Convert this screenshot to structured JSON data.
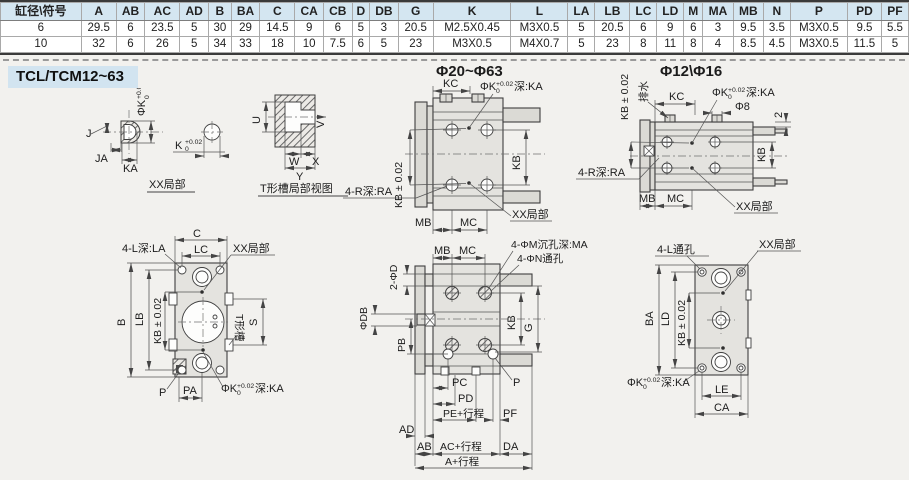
{
  "table": {
    "headers": [
      "缸径\\符号",
      "A",
      "AB",
      "AC",
      "AD",
      "B",
      "BA",
      "C",
      "CA",
      "CB",
      "D",
      "DB",
      "G",
      "K",
      "L",
      "LA",
      "LB",
      "LC",
      "LD",
      "M",
      "MA",
      "MB",
      "N",
      "P",
      "PD",
      "PF"
    ],
    "rows": [
      [
        "6",
        "29.5",
        "6",
        "23.5",
        "5",
        "30",
        "29",
        "14.5",
        "9",
        "6",
        "5",
        "3",
        "20.5",
        "M2.5X0.45",
        "M3X0.5",
        "5",
        "20.5",
        "6",
        "9",
        "6",
        "3",
        "9.5",
        "3.5",
        "M3X0.5",
        "9.5",
        "5.5"
      ],
      [
        "10",
        "32",
        "6",
        "26",
        "5",
        "34",
        "33",
        "18",
        "10",
        "7.5",
        "6",
        "5",
        "23",
        "M3X0.5",
        "M4X0.7",
        "5",
        "23",
        "8",
        "11",
        "8",
        "4",
        "8.5",
        "4.5",
        "M3X0.5",
        "11.5",
        "5"
      ]
    ]
  },
  "section_title": "TCL/TCM12~63",
  "tol": {
    "up": "+0.02",
    "dn": "0"
  },
  "colors": {
    "header_bg": "#d4e6f1",
    "section_bg": "#d2e4f0",
    "page_bg": "#f2f1ee",
    "line": "#3f3f3f",
    "body_fill": "#e4e3df"
  },
  "views": {
    "dome": {
      "caption": "XX局部",
      "j": "J",
      "ja": "JA",
      "ka": "KA",
      "phik": "ΦK",
      "k": "K"
    },
    "tslot": {
      "caption": "T形槽局部视图",
      "u": "U",
      "v": "V",
      "w": "W",
      "x": "X",
      "y": "Y"
    },
    "mid": {
      "title": "Φ20~Φ63",
      "kc": "KC",
      "phik": "ΦK",
      "depth_ka": "深:KA",
      "kb_tol": "KB ± 0.02",
      "kb": "KB",
      "r_depth": "4-R深:RA",
      "xx": "XX局部",
      "mb": "MB",
      "mc": "MC"
    },
    "right": {
      "title": "Φ12\\Φ16",
      "kb_tol": "KB ± 0.02",
      "drain": "排水",
      "kc": "KC",
      "phik": "ΦK",
      "depth_ka": "深:KA",
      "phi8": "Φ8",
      "two": "2",
      "kb": "KB",
      "r_depth": "4-R深:RA",
      "mb": "MB",
      "mc": "MC",
      "xx": "XX局部"
    },
    "front": {
      "l_depth": "4-L深:LA",
      "c": "C",
      "lc": "LC",
      "xx": "XX局部",
      "b": "B",
      "lb": "LB",
      "kb_tol": "KB ± 0.02",
      "s": "S",
      "tslot": "T形槽",
      "p": "P",
      "pa": "PA",
      "phik": "ΦK",
      "depth_ka": "深:KA"
    },
    "sec": {
      "mb": "MB",
      "mc": "MC",
      "m_holes": "4-ΦM沉孔深:MA",
      "n_holes": "4-ΦN通孔",
      "two_d": "2-ΦD",
      "db": "ΦDB",
      "pb": "PB",
      "kb": "KB",
      "g": "G",
      "p": "P",
      "pc": "PC",
      "pd": "PD",
      "pe": "PE+行程",
      "pf": "PF",
      "ad": "AD",
      "ab": "AB",
      "ac": "AC+行程",
      "da": "DA",
      "a": "A+行程"
    },
    "rear": {
      "l_holes": "4-L通孔",
      "xx": "XX局部",
      "ba": "BA",
      "ld": "LD",
      "kb_tol": "KB ± 0.02",
      "phik": "ΦK",
      "depth_ka": "深:KA",
      "le": "LE",
      "ca": "CA"
    }
  }
}
